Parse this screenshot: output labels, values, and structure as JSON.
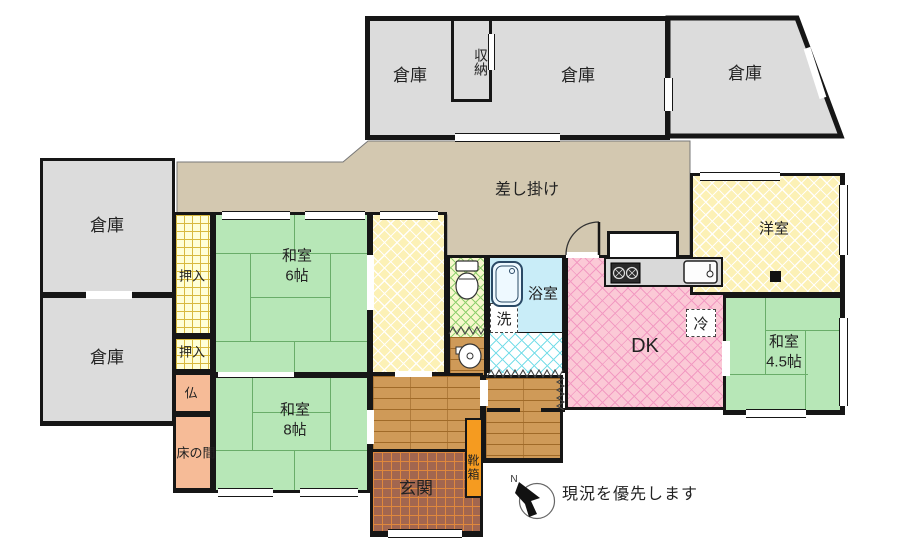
{
  "plan": {
    "note": "現況を優先します",
    "compass_letter": "N",
    "labels": {
      "souko": "倉庫",
      "shunou": "収納",
      "sashikake": "差し掛け",
      "oshiire": "押入",
      "butsudan": "仏",
      "tokonoma": "床の間",
      "washitsu": "和室",
      "size6": "6帖",
      "size8": "8帖",
      "size45": "4.5帖",
      "yoshitsu": "洋室",
      "dk": "DK",
      "yokushitsu": "浴室",
      "laundry": "洗",
      "fridge": "冷",
      "genkan": "玄関",
      "kutsubako": "靴箱"
    },
    "colors": {
      "wall": "#161616",
      "storage_gray": "#dcdcdc",
      "lean_to_tan": "#d3c8b0",
      "tatami_green": "#b7e7b7",
      "closet_grid_yellow": "#ffffd6",
      "alcove_salmon": "#f6bb97",
      "western_yellow": "#fcf1b6",
      "dk_pink": "#fbc9d6",
      "bath_blue": "#c9edf8",
      "toilet_green": "#8fd06e",
      "washroom_cyan": "#79dee9",
      "hall_wood": "#cf9a58",
      "entry_tile": "#a2664f",
      "shoe_box_orange": "#f59b20"
    }
  }
}
